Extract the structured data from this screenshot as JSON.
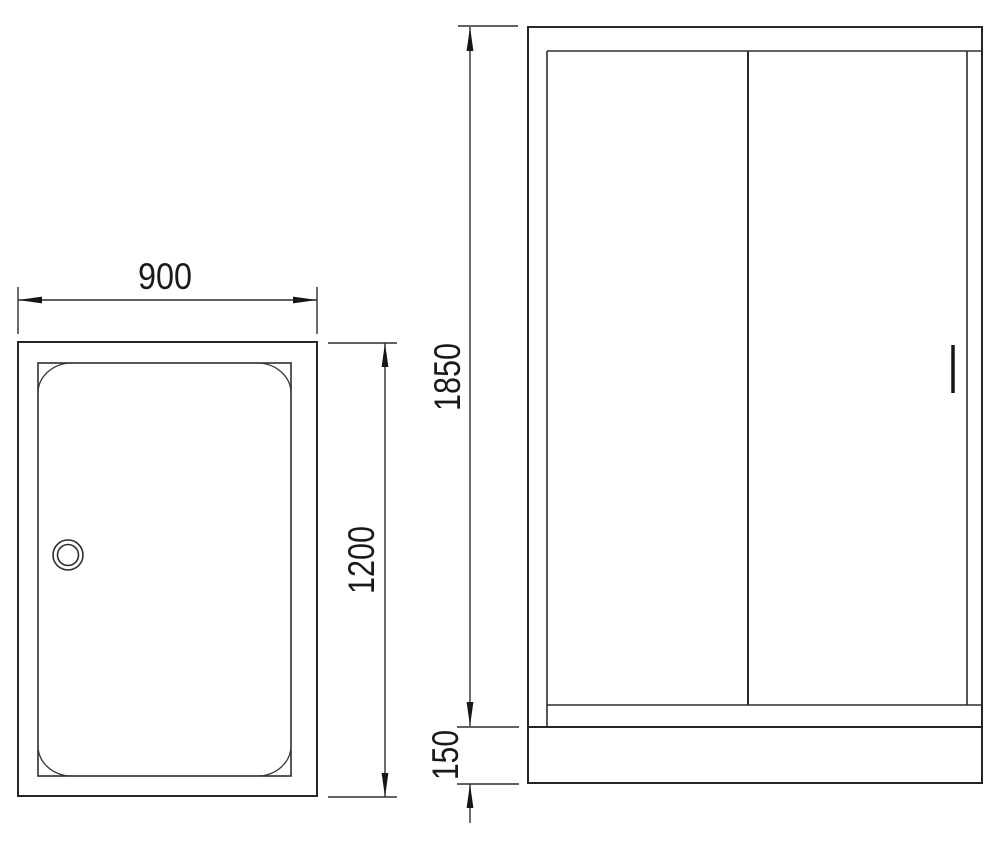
{
  "drawing": {
    "kind": "shower enclosure technical drawing, two orthographic views",
    "colors": {
      "background": "#ffffff",
      "line": "#2a2a2a",
      "text": "#1a1a1a"
    },
    "labels": {
      "tray_width": "900",
      "tray_depth": "1200",
      "door_height": "1850",
      "tray_height": "150"
    }
  }
}
